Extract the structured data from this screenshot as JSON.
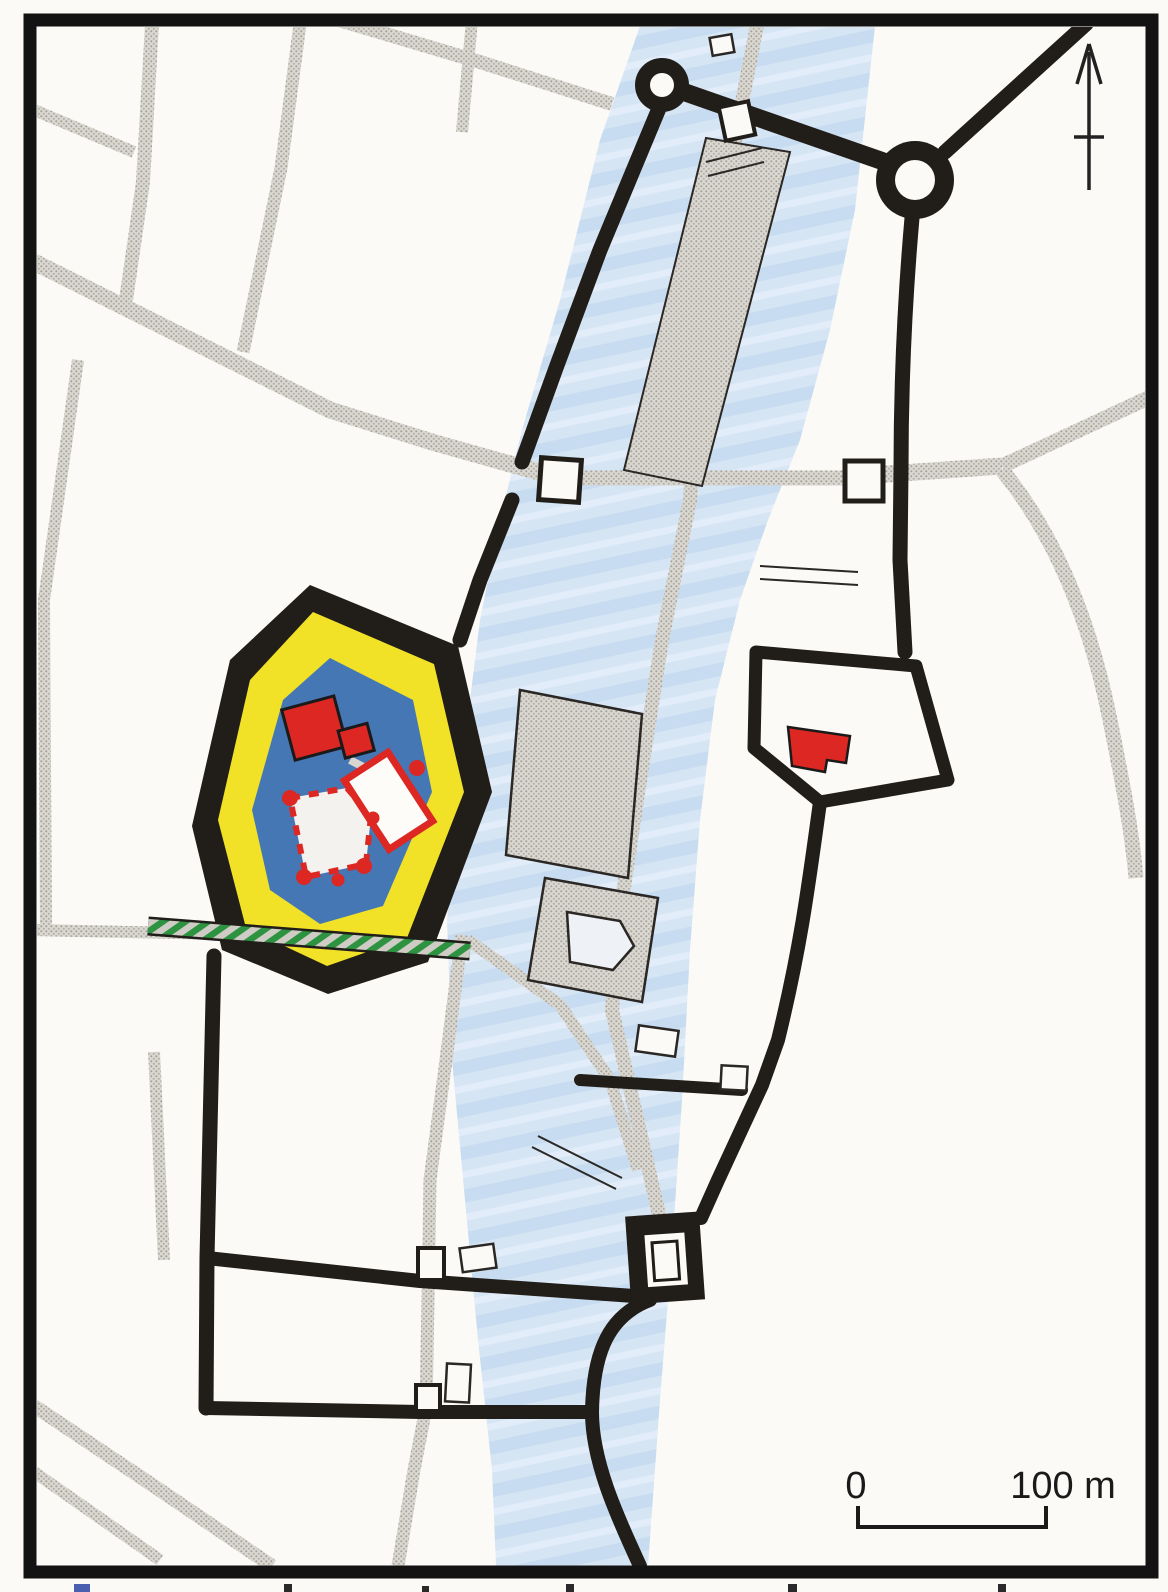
{
  "map": {
    "scale_bar": {
      "zero_label": "0",
      "hundred_label": "100 m"
    },
    "colors": {
      "paper": "#fbfaf6",
      "frame": "#131313",
      "wall": "#211d19",
      "street_base": "#dbd8d2",
      "street_dot": "#a5a19b",
      "river_base": "#d5e5f4",
      "river_dark": "#c7dcf0",
      "river_light": "#e2edf9",
      "castle_yellow": "#f1e228",
      "castle_moat_blue": "#4577b4",
      "building_red": "#dc2723",
      "hatch_green": "#2e9340",
      "thin_line": "#2a2724",
      "label_ink": "#1a1a1a"
    }
  }
}
